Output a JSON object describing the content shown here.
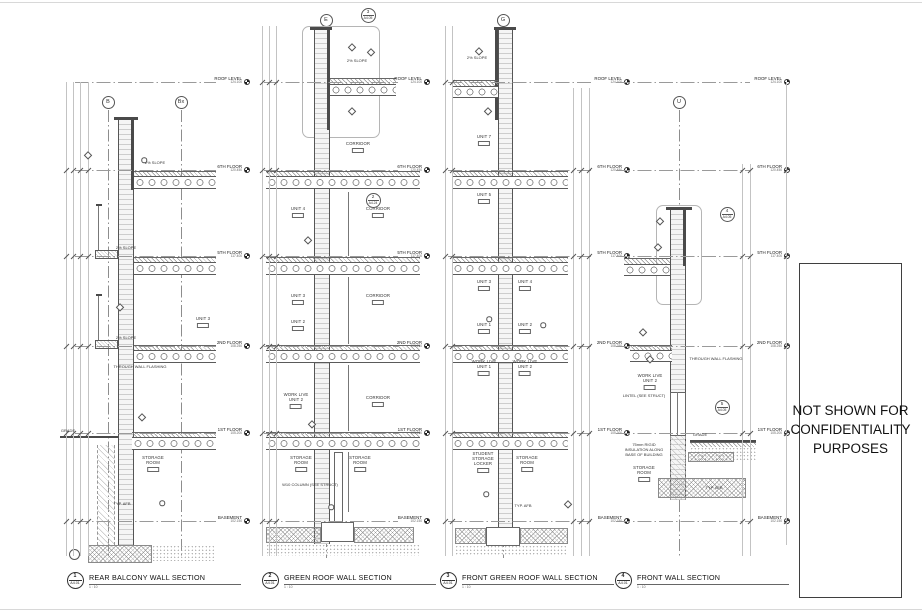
{
  "canvas": {
    "w": 922,
    "h": 615
  },
  "confidentiality": {
    "text": "NOT SHOWN FOR\nCONFIDENTIALITY\nPURPOSES",
    "x": 799,
    "y": 263,
    "w": 103,
    "h": 335
  },
  "levels": [
    {
      "name": "ROOF LEVEL",
      "elev": "124.100",
      "y": 82
    },
    {
      "name": "6TH FLOOR",
      "elev": "120.450",
      "y": 170
    },
    {
      "name": "5TH FLOOR",
      "elev": "117.400",
      "y": 256
    },
    {
      "name": "2ND FLOOR",
      "elev": "108.250",
      "y": 346
    },
    {
      "name": "1ST FLOOR",
      "elev": "105.200",
      "y": 433
    },
    {
      "name": "BASEMENT",
      "elev": "102.150",
      "y": 521
    }
  ],
  "sections": [
    {
      "num": "1",
      "sheet": "A4.01",
      "title": "REAR BALCONY WALL SECTION",
      "scale": "1 : 10",
      "marker_x": 75,
      "title_x": 89,
      "lx1": 75,
      "lx2": 216,
      "labx": 248,
      "bubbles": [
        [
          "B",
          108,
          102
        ],
        [
          "Bx",
          181,
          102
        ]
      ],
      "grids": [
        [
          108,
          110,
          558
        ],
        [
          181,
          110,
          558
        ]
      ],
      "callouts": [],
      "detrects": [],
      "shapes": [
        [
          "dark",
          114,
          117,
          24,
          3,
          "parapet-cap"
        ],
        [
          "wallh",
          118,
          120,
          16,
          425,
          "balcony-wall"
        ],
        [
          "dark",
          131,
          120,
          3,
          70,
          "wall-liner"
        ],
        [
          "hatch45",
          134,
          171,
          82,
          5,
          "floor-topping"
        ],
        [
          "plank",
          134,
          176,
          82,
          13,
          "floor-slab"
        ],
        [
          "hatch45",
          134,
          257,
          82,
          5,
          "floor-topping"
        ],
        [
          "plank",
          134,
          262,
          82,
          13,
          "floor-slab"
        ],
        [
          "deck",
          95,
          250,
          23,
          9,
          "balcony-deck"
        ],
        [
          "line",
          98,
          205,
          1,
          45,
          "railing-post"
        ],
        [
          "dark",
          96,
          204,
          6,
          2,
          "railing-cap"
        ],
        [
          "hatch45",
          134,
          345,
          82,
          5,
          "floor-topping"
        ],
        [
          "plank",
          134,
          350,
          82,
          13,
          "floor-slab"
        ],
        [
          "deck",
          95,
          340,
          23,
          9,
          "balcony-deck"
        ],
        [
          "line",
          98,
          295,
          1,
          45,
          "railing-post"
        ],
        [
          "dark",
          96,
          294,
          6,
          2,
          "railing-cap"
        ],
        [
          "hatch45",
          132,
          432,
          84,
          5,
          "floor-topping"
        ],
        [
          "plank",
          132,
          437,
          84,
          13,
          "floor-slab"
        ],
        [
          "dark",
          60,
          436,
          58,
          2,
          "grade-line"
        ],
        [
          "found",
          97,
          445,
          18,
          100,
          "foundation-wall"
        ],
        [
          "crossh",
          88,
          545,
          64,
          18,
          "footing"
        ],
        [
          "stipple",
          152,
          545,
          64,
          16,
          "earth"
        ],
        [
          "circ",
          69,
          549,
          11,
          11,
          "drain-pipe"
        ]
      ],
      "rooms": [
        {
          "t": "UNIT 3",
          "x": 203,
          "y": 317
        },
        {
          "t": "STORAGE\nROOM",
          "x": 153,
          "y": 456
        }
      ],
      "notes": [
        {
          "t": "2% SLOPE",
          "x": 155,
          "y": 161
        },
        {
          "t": "2% SLOPE",
          "x": 126,
          "y": 246
        },
        {
          "t": "2% SLOPE",
          "x": 126,
          "y": 336
        },
        {
          "t": "THROUGH WALL FLASHING",
          "x": 140,
          "y": 365
        },
        {
          "t": "GRADE",
          "x": 68,
          "y": 429
        },
        {
          "t": "TYP. AFB",
          "x": 122,
          "y": 502
        }
      ],
      "markers": [
        [
          "d",
          88,
          155
        ],
        [
          "c",
          144,
          160
        ],
        [
          "d",
          120,
          307
        ],
        [
          "d",
          142,
          417
        ],
        [
          "c",
          162,
          503
        ]
      ],
      "dims": [
        [
          66,
          82,
          556
        ],
        [
          73,
          82,
          556
        ],
        [
          80,
          82,
          556
        ],
        [
          88,
          82,
          556
        ]
      ]
    },
    {
      "num": "2",
      "sheet": "A4.01",
      "title": "GREEN ROOF WALL SECTION",
      "scale": "1 : 10",
      "marker_x": 270,
      "title_x": 284,
      "lx1": 264,
      "lx2": 398,
      "labx": 428,
      "bubbles": [
        [
          "E",
          326,
          20
        ]
      ],
      "grids": [
        [
          326,
          28,
          558
        ]
      ],
      "callouts": [
        [
          "3",
          "A4.05",
          368,
          15
        ],
        [
          "2",
          "A4.24",
          373,
          200
        ]
      ],
      "detrects": [
        [
          302,
          26,
          78,
          112
        ]
      ],
      "shapes": [
        [
          "dark",
          310,
          27,
          22,
          3,
          "parapet-cap"
        ],
        [
          "wallh",
          314,
          30,
          16,
          514,
          "exterior-wall"
        ],
        [
          "dark",
          327,
          30,
          3,
          100,
          "wall-liner"
        ],
        [
          "hatch45",
          330,
          78,
          66,
          6,
          "green-roof-layer"
        ],
        [
          "plank",
          330,
          84,
          66,
          12,
          "roof-slab"
        ],
        [
          "hatch45",
          266,
          171,
          154,
          5,
          "floor-topping"
        ],
        [
          "plank",
          266,
          176,
          154,
          13,
          "floor-slab"
        ],
        [
          "hatch45",
          266,
          257,
          154,
          5,
          "floor-topping"
        ],
        [
          "plank",
          266,
          262,
          154,
          13,
          "floor-slab"
        ],
        [
          "hatch45",
          266,
          345,
          154,
          5,
          "floor-topping"
        ],
        [
          "plank",
          266,
          350,
          154,
          13,
          "floor-slab"
        ],
        [
          "hatch45",
          266,
          432,
          154,
          5,
          "floor-topping"
        ],
        [
          "plank",
          266,
          437,
          154,
          13,
          "floor-slab"
        ],
        [
          "line",
          348,
          192,
          1,
          64,
          "partition-wall"
        ],
        [
          "line",
          348,
          277,
          1,
          67,
          "partition-wall"
        ],
        [
          "line",
          348,
          365,
          1,
          66,
          "partition-wall"
        ],
        [
          "line",
          348,
          452,
          1,
          60,
          "partition-wall"
        ],
        [
          "whitebox",
          334,
          452,
          9,
          70,
          "column"
        ],
        [
          "crossh",
          266,
          527,
          55,
          16,
          "foundation"
        ],
        [
          "crossh",
          354,
          527,
          60,
          16,
          "foundation"
        ],
        [
          "whitebox",
          321,
          522,
          33,
          20,
          "footing"
        ],
        [
          "stipple",
          266,
          544,
          154,
          12,
          "earth"
        ]
      ],
      "rooms": [
        {
          "t": "CORRIDOR",
          "x": 358,
          "y": 142
        },
        {
          "t": "UNIT 4",
          "x": 298,
          "y": 207
        },
        {
          "t": "CORRIDOR",
          "x": 378,
          "y": 207
        },
        {
          "t": "UNIT 3",
          "x": 298,
          "y": 294
        },
        {
          "t": "CORRIDOR",
          "x": 378,
          "y": 294
        },
        {
          "t": "UNIT 2",
          "x": 298,
          "y": 320
        },
        {
          "t": "WORK LIVE\nUNIT 2",
          "x": 296,
          "y": 393
        },
        {
          "t": "CORRIDOR",
          "x": 378,
          "y": 396
        },
        {
          "t": "STORAGE\nROOM",
          "x": 301,
          "y": 456
        },
        {
          "t": "STORAGE\nROOM",
          "x": 360,
          "y": 456
        }
      ],
      "notes": [
        {
          "t": "2% SLOPE",
          "x": 357,
          "y": 59
        },
        {
          "t": "W10 COLUMN (SEE STRUCT)",
          "x": 310,
          "y": 483
        }
      ],
      "markers": [
        [
          "d",
          352,
          47
        ],
        [
          "d",
          371,
          52
        ],
        [
          "d",
          352,
          111
        ],
        [
          "d",
          308,
          240
        ],
        [
          "d",
          312,
          424
        ],
        [
          "c",
          331,
          507
        ]
      ],
      "dims": [
        [
          262,
          26,
          556
        ],
        [
          269,
          26,
          556
        ],
        [
          276,
          26,
          556
        ]
      ]
    },
    {
      "num": "3",
      "sheet": "A4.01",
      "title": "FRONT GREEN ROOF WALL SECTION",
      "scale": "1 : 10",
      "marker_x": 448,
      "title_x": 462,
      "lx1": 448,
      "lx2": 594,
      "labx": 628,
      "bubbles": [
        [
          "G",
          503,
          20
        ]
      ],
      "grids": [
        [
          503,
          28,
          558
        ]
      ],
      "callouts": [],
      "detrects": [],
      "shapes": [
        [
          "dark",
          494,
          27,
          22,
          3,
          "parapet-cap"
        ],
        [
          "wallh",
          498,
          30,
          15,
          514,
          "exterior-wall"
        ],
        [
          "dark",
          495,
          30,
          3,
          90,
          "wall-liner"
        ],
        [
          "hatch45",
          452,
          80,
          46,
          6,
          "green-roof-layer"
        ],
        [
          "plank",
          452,
          86,
          46,
          12,
          "roof-slab"
        ],
        [
          "hatch45",
          452,
          171,
          116,
          5,
          "floor-topping"
        ],
        [
          "plank",
          452,
          176,
          116,
          13,
          "floor-slab"
        ],
        [
          "hatch45",
          452,
          257,
          116,
          5,
          "floor-topping"
        ],
        [
          "plank",
          452,
          262,
          116,
          13,
          "floor-slab"
        ],
        [
          "hatch45",
          452,
          345,
          116,
          5,
          "floor-topping"
        ],
        [
          "plank",
          452,
          350,
          116,
          13,
          "floor-slab"
        ],
        [
          "hatch45",
          452,
          432,
          116,
          5,
          "floor-topping"
        ],
        [
          "plank",
          452,
          437,
          116,
          13,
          "floor-slab"
        ],
        [
          "crossh",
          455,
          528,
          31,
          16,
          "foundation"
        ],
        [
          "crossh",
          520,
          528,
          48,
          16,
          "foundation"
        ],
        [
          "whitebox",
          486,
          527,
          34,
          19,
          "footing"
        ],
        [
          "stipple",
          455,
          545,
          113,
          11,
          "earth"
        ]
      ],
      "rooms": [
        {
          "t": "UNIT 7",
          "x": 484,
          "y": 135
        },
        {
          "t": "UNIT 5",
          "x": 484,
          "y": 193
        },
        {
          "t": "UNIT 3",
          "x": 484,
          "y": 280
        },
        {
          "t": "UNIT 4",
          "x": 525,
          "y": 280
        },
        {
          "t": "UNIT 1",
          "x": 484,
          "y": 323
        },
        {
          "t": "UNIT 2",
          "x": 525,
          "y": 323
        },
        {
          "t": "WORK LIVE\nUNIT 1",
          "x": 484,
          "y": 360
        },
        {
          "t": "WORK LIVE\nUNIT 2",
          "x": 525,
          "y": 360
        },
        {
          "t": "STUDENT\nSTORAGE\nLOCKER",
          "x": 483,
          "y": 452
        },
        {
          "t": "STORAGE\nROOM",
          "x": 527,
          "y": 456
        }
      ],
      "notes": [
        {
          "t": "2% SLOPE",
          "x": 477,
          "y": 56
        },
        {
          "t": "TYP. AFB",
          "x": 523,
          "y": 504
        }
      ],
      "markers": [
        [
          "d",
          479,
          51
        ],
        [
          "d",
          488,
          111
        ],
        [
          "c",
          489,
          319
        ],
        [
          "c",
          543,
          325
        ],
        [
          "c",
          486,
          494
        ],
        [
          "d",
          568,
          504
        ]
      ],
      "dims": [
        [
          445,
          26,
          556
        ],
        [
          452,
          26,
          556
        ],
        [
          573,
          88,
          556
        ],
        [
          581,
          88,
          556
        ],
        [
          589,
          88,
          556
        ]
      ]
    },
    {
      "num": "4",
      "sheet": "A4.01",
      "title": "FRONT WALL SECTION",
      "scale": "1 : 10",
      "marker_x": 623,
      "title_x": 637,
      "lx1": 616,
      "lx2": 750,
      "labx": 788,
      "bubbles": [
        [
          "U",
          679,
          102
        ]
      ],
      "grids": [
        [
          679,
          110,
          558
        ]
      ],
      "callouts": [
        [
          "4",
          "A4.05",
          727,
          214
        ],
        [
          "5",
          "A4.05",
          722,
          407
        ]
      ],
      "detrects": [
        [
          656,
          205,
          46,
          100
        ]
      ],
      "shapes": [
        [
          "dark",
          666,
          207,
          26,
          3,
          "parapet-cap"
        ],
        [
          "wallh",
          670,
          210,
          16,
          290,
          "front-wall"
        ],
        [
          "dark",
          683,
          210,
          3,
          56,
          "wall-liner"
        ],
        [
          "hatch45",
          624,
          258,
          46,
          6,
          "terrace-layer"
        ],
        [
          "plank",
          624,
          264,
          46,
          12,
          "terrace-slab"
        ],
        [
          "hatch45",
          630,
          345,
          42,
          5,
          "floor-topping"
        ],
        [
          "plank",
          630,
          350,
          42,
          12,
          "floor-slab"
        ],
        [
          "whitebox",
          670,
          392,
          16,
          44,
          "window-frame"
        ],
        [
          "line",
          677,
          392,
          1,
          44,
          "window-mullion"
        ],
        [
          "dark",
          690,
          440,
          66,
          2,
          "grade-line"
        ],
        [
          "hatch45",
          690,
          442,
          66,
          5,
          "grade-slab"
        ],
        [
          "stipple",
          690,
          447,
          66,
          14,
          "earth"
        ],
        [
          "crossh",
          688,
          452,
          46,
          10,
          "rigid-insulation"
        ],
        [
          "found",
          670,
          436,
          16,
          64,
          "foundation-wall"
        ],
        [
          "crossh",
          658,
          478,
          88,
          20,
          "footing"
        ]
      ],
      "rooms": [
        {
          "t": "WORK LIVE\nUNIT 2",
          "x": 650,
          "y": 374
        },
        {
          "t": "STORAGE\nROOM",
          "x": 644,
          "y": 466
        }
      ],
      "notes": [
        {
          "t": "THROUGH WALL FLASHING",
          "x": 716,
          "y": 357
        },
        {
          "t": "LINTEL (SEE STRUCT)",
          "x": 644,
          "y": 394
        },
        {
          "t": "GRADE",
          "x": 700,
          "y": 433
        },
        {
          "t": "TYP. AFB",
          "x": 714,
          "y": 486
        },
        {
          "t": "75mm RIGID\nINSULATION ALONG\nBASE OF BUILDING",
          "x": 644,
          "y": 443
        }
      ],
      "markers": [
        [
          "d",
          660,
          221
        ],
        [
          "d",
          658,
          247
        ],
        [
          "d",
          643,
          332
        ],
        [
          "d",
          650,
          359
        ]
      ],
      "dims": [
        [
          742,
          164,
          556
        ],
        [
          750,
          164,
          556
        ],
        [
          786,
          82,
          545
        ]
      ]
    }
  ]
}
